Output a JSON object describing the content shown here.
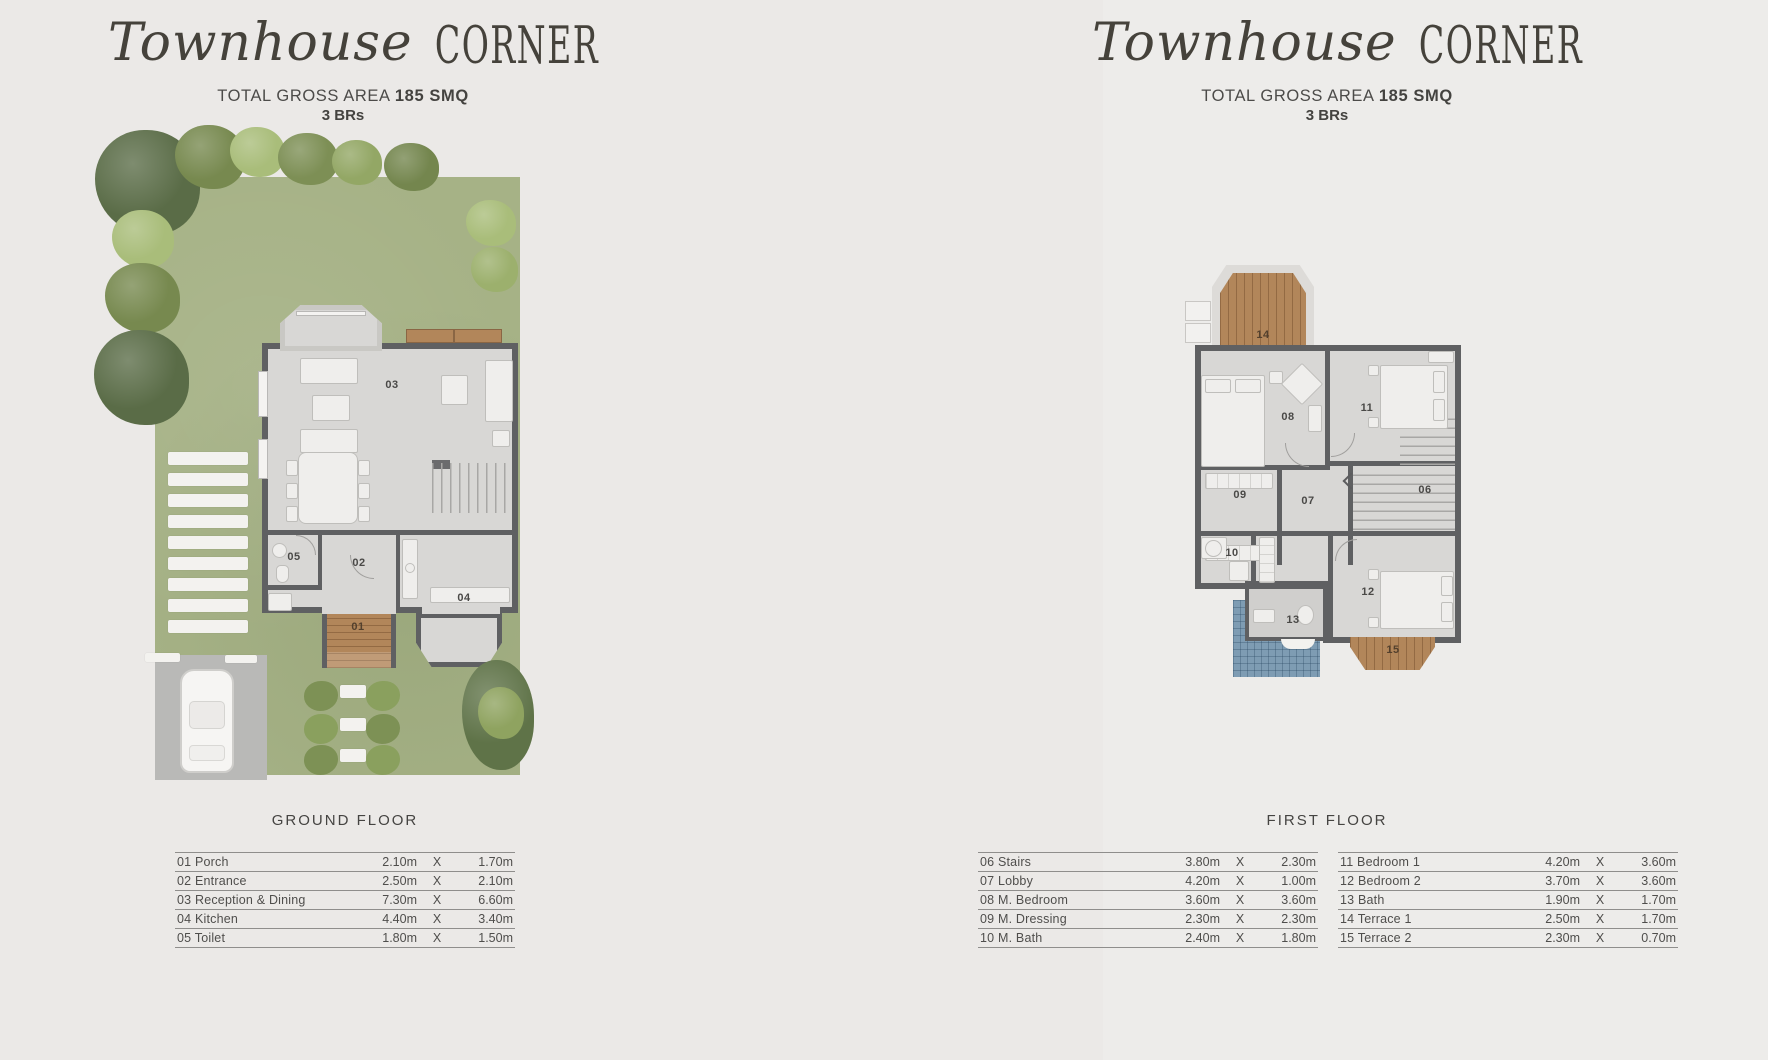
{
  "sep": "X",
  "colors": {
    "background": "#ebe9e7",
    "grass": "#a6b286",
    "wall": "#5f6062",
    "floor": "#d8d7d5",
    "wood": "#b2865a",
    "tile_blue": "#7e9cb3"
  },
  "header": {
    "script": "Townhouse",
    "caps": "CORNER",
    "area_label": "TOTAL GROSS AREA",
    "area_value": "185 SMQ",
    "brs": "3 BRs"
  },
  "ground": {
    "floor_label": "GROUND FLOOR",
    "rooms": {
      "r01": "01",
      "r02": "02",
      "r03": "03",
      "r04": "04",
      "r05": "05"
    },
    "table": [
      {
        "name": "01 Porch",
        "w": "2.10m",
        "h": "1.70m"
      },
      {
        "name": "02 Entrance",
        "w": "2.50m",
        "h": "2.10m"
      },
      {
        "name": "03 Reception & Dining",
        "w": "7.30m",
        "h": "6.60m"
      },
      {
        "name": "04 Kitchen",
        "w": "4.40m",
        "h": "3.40m"
      },
      {
        "name": "05 Toilet",
        "w": "1.80m",
        "h": "1.50m"
      }
    ]
  },
  "first": {
    "floor_label": "FIRST FLOOR",
    "rooms": {
      "r06": "06",
      "r07": "07",
      "r08": "08",
      "r09": "09",
      "r10": "10",
      "r11": "11",
      "r12": "12",
      "r13": "13",
      "r14": "14",
      "r15": "15"
    },
    "table_left": [
      {
        "name": "06 Stairs",
        "w": "3.80m",
        "h": "2.30m"
      },
      {
        "name": "07 Lobby",
        "w": "4.20m",
        "h": "1.00m"
      },
      {
        "name": "08 M. Bedroom",
        "w": "3.60m",
        "h": "3.60m"
      },
      {
        "name": "09 M. Dressing",
        "w": "2.30m",
        "h": "2.30m"
      },
      {
        "name": "10 M. Bath",
        "w": "2.40m",
        "h": "1.80m"
      }
    ],
    "table_right": [
      {
        "name": "11 Bedroom 1",
        "w": "4.20m",
        "h": "3.60m"
      },
      {
        "name": "12 Bedroom 2",
        "w": "3.70m",
        "h": "3.60m"
      },
      {
        "name": "13 Bath",
        "w": "1.90m",
        "h": "1.70m"
      },
      {
        "name": "14 Terrace 1",
        "w": "2.50m",
        "h": "1.70m"
      },
      {
        "name": "15 Terrace 2",
        "w": "2.30m",
        "h": "0.70m"
      }
    ]
  }
}
